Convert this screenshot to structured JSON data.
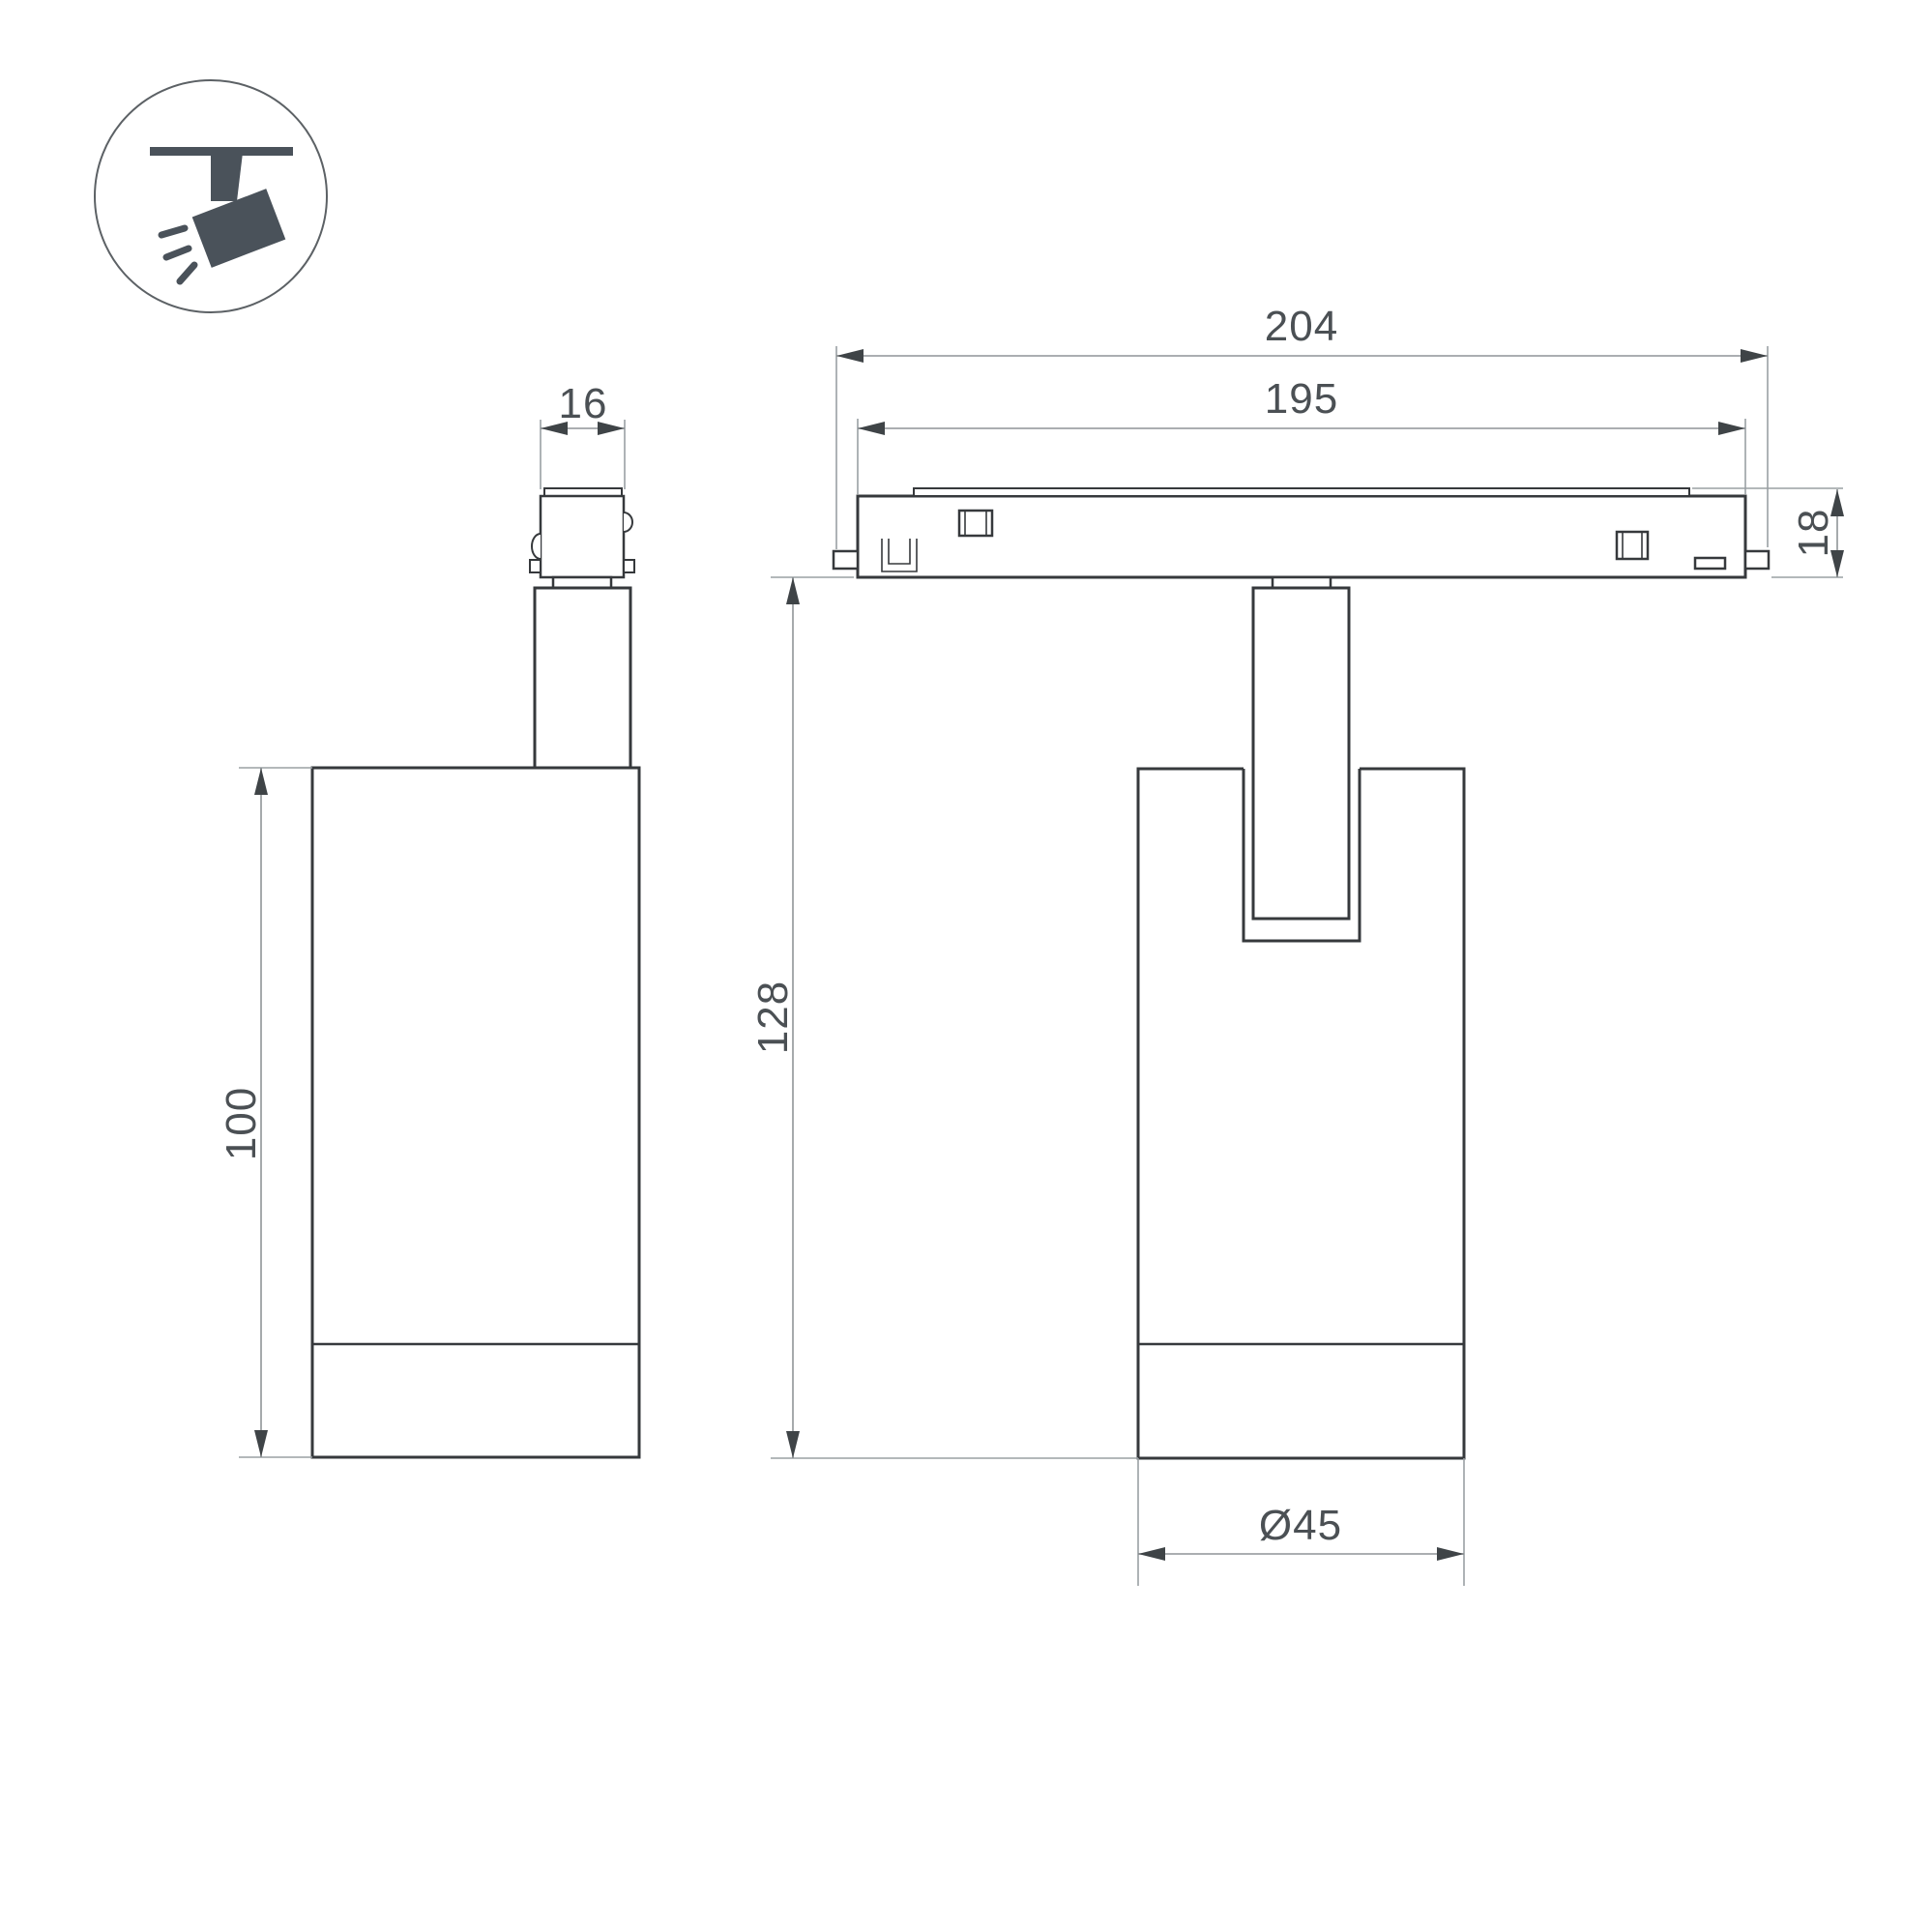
{
  "page": {
    "type": "technical-dimension-drawing",
    "product": "magnetic track spotlight",
    "background": "#ffffff"
  },
  "colors": {
    "outline": "#36393c",
    "dimension_lines": "#9aa0a3",
    "dimension_text": "#4b5054",
    "arrowheads": "#3f4447",
    "icon": "#4a525a"
  },
  "icon": {
    "name": "track-spotlight-pictogram"
  },
  "views": {
    "side_view": {
      "dimensions": {
        "stem_width": "16",
        "body_height": "100"
      }
    },
    "front_view": {
      "dimensions": {
        "track_overall": "204",
        "track_length": "195",
        "track_height": "18",
        "overall_height": "128",
        "body_diameter": "Ø45"
      }
    }
  }
}
